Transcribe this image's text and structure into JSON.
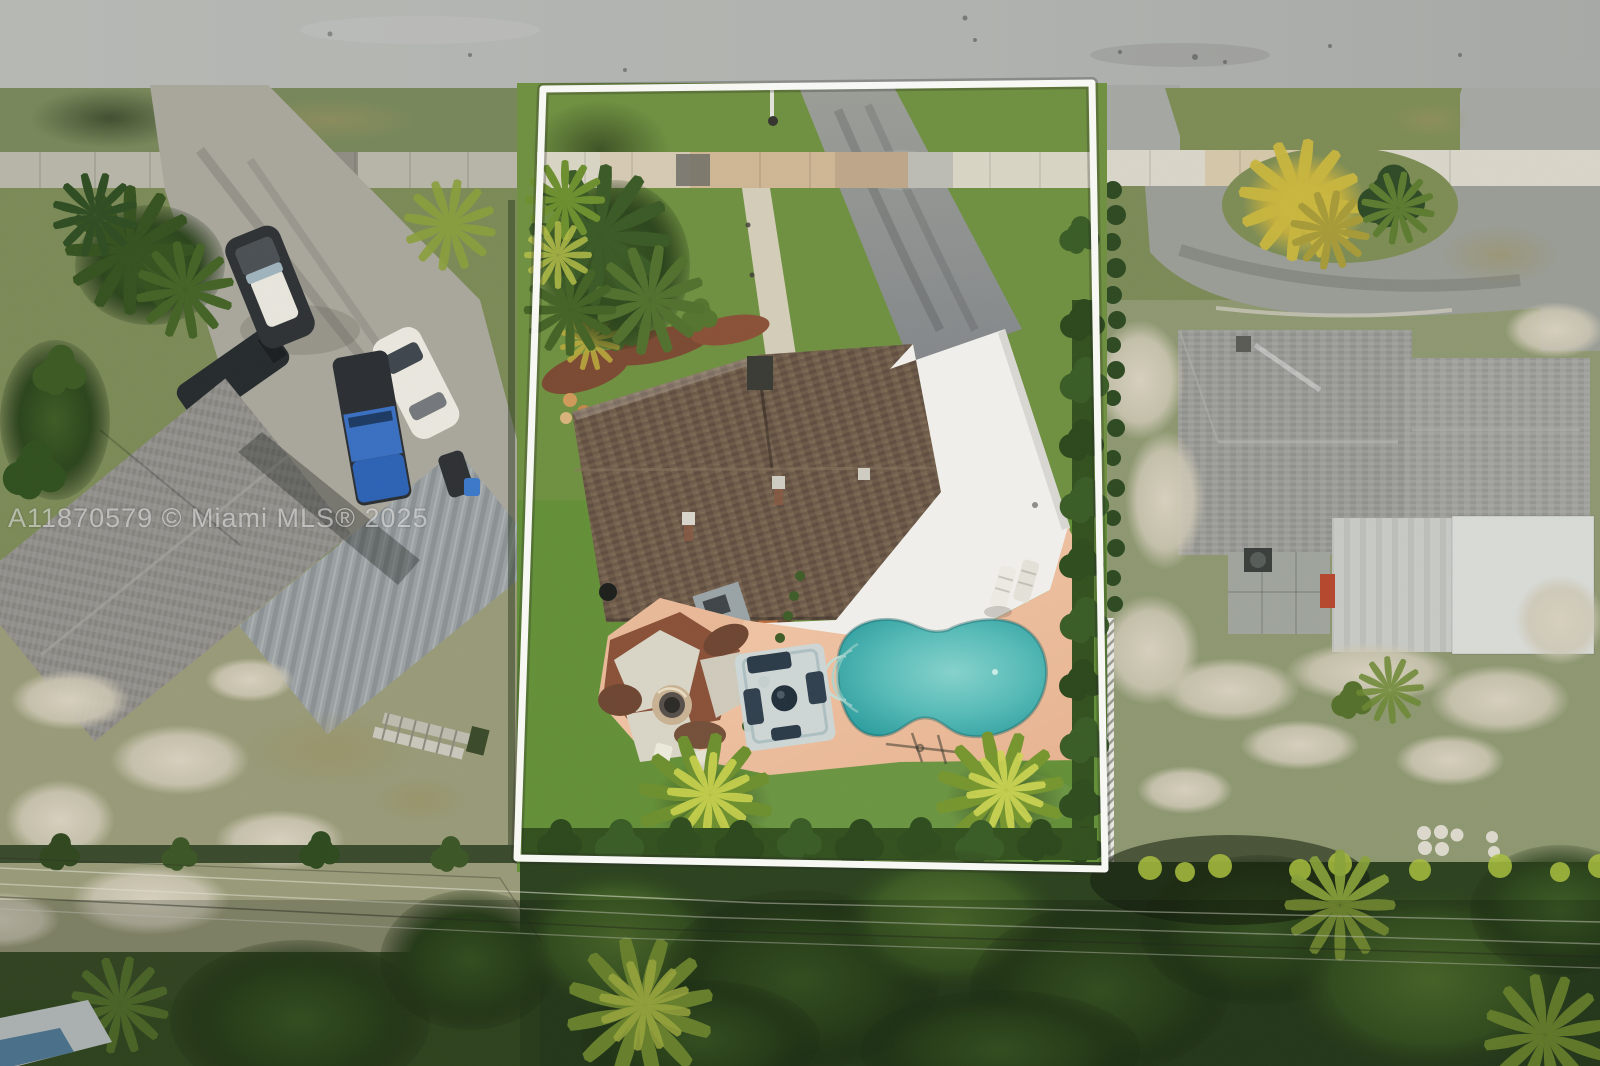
{
  "watermark": {
    "text": "A11870579 © Miami MLS® 2025"
  },
  "scene": {
    "type": "aerial-drone-photo",
    "description": "Top-down aerial view of a single-family residential lot outlined with a white boundary: brown shingle roof house with white flat roof section, freeform turquoise pool on a peach paver deck, fire-pit patio, front walkway and asphalt driveway to a street at top, palm trees, dense tree line with power lines at bottom, neighboring homes with parked cars on the left and a gray-roof home with cul-de-sac drive on the right",
    "palette": {
      "road": "#b2b4b1",
      "sidewalk": "#d9d5c5",
      "sidewalkLeft": "#b7b4a8",
      "grassLeft": "#7b8a57",
      "grassLawn": "#6f9041",
      "grassBack": "#649038",
      "grassRight": "#8d9770",
      "asphalt": "#94978f",
      "roofBrown": "#6d5a49",
      "roofWhite": "#f0efeb",
      "roofGrayLeft": "#8f8e89",
      "roofMetal": "#9ba1a3",
      "roofGrayRight": "#9a9a96",
      "flatLight": "#c7c9c5",
      "deck": "#eec2a4",
      "pool": "#45aeac",
      "mulch": "#744a34",
      "canopy": "#2c421f",
      "boundary": "#f8f8f5",
      "fence": "#e8e8e2",
      "watermark": "rgba(255,255,255,0.52)"
    }
  }
}
